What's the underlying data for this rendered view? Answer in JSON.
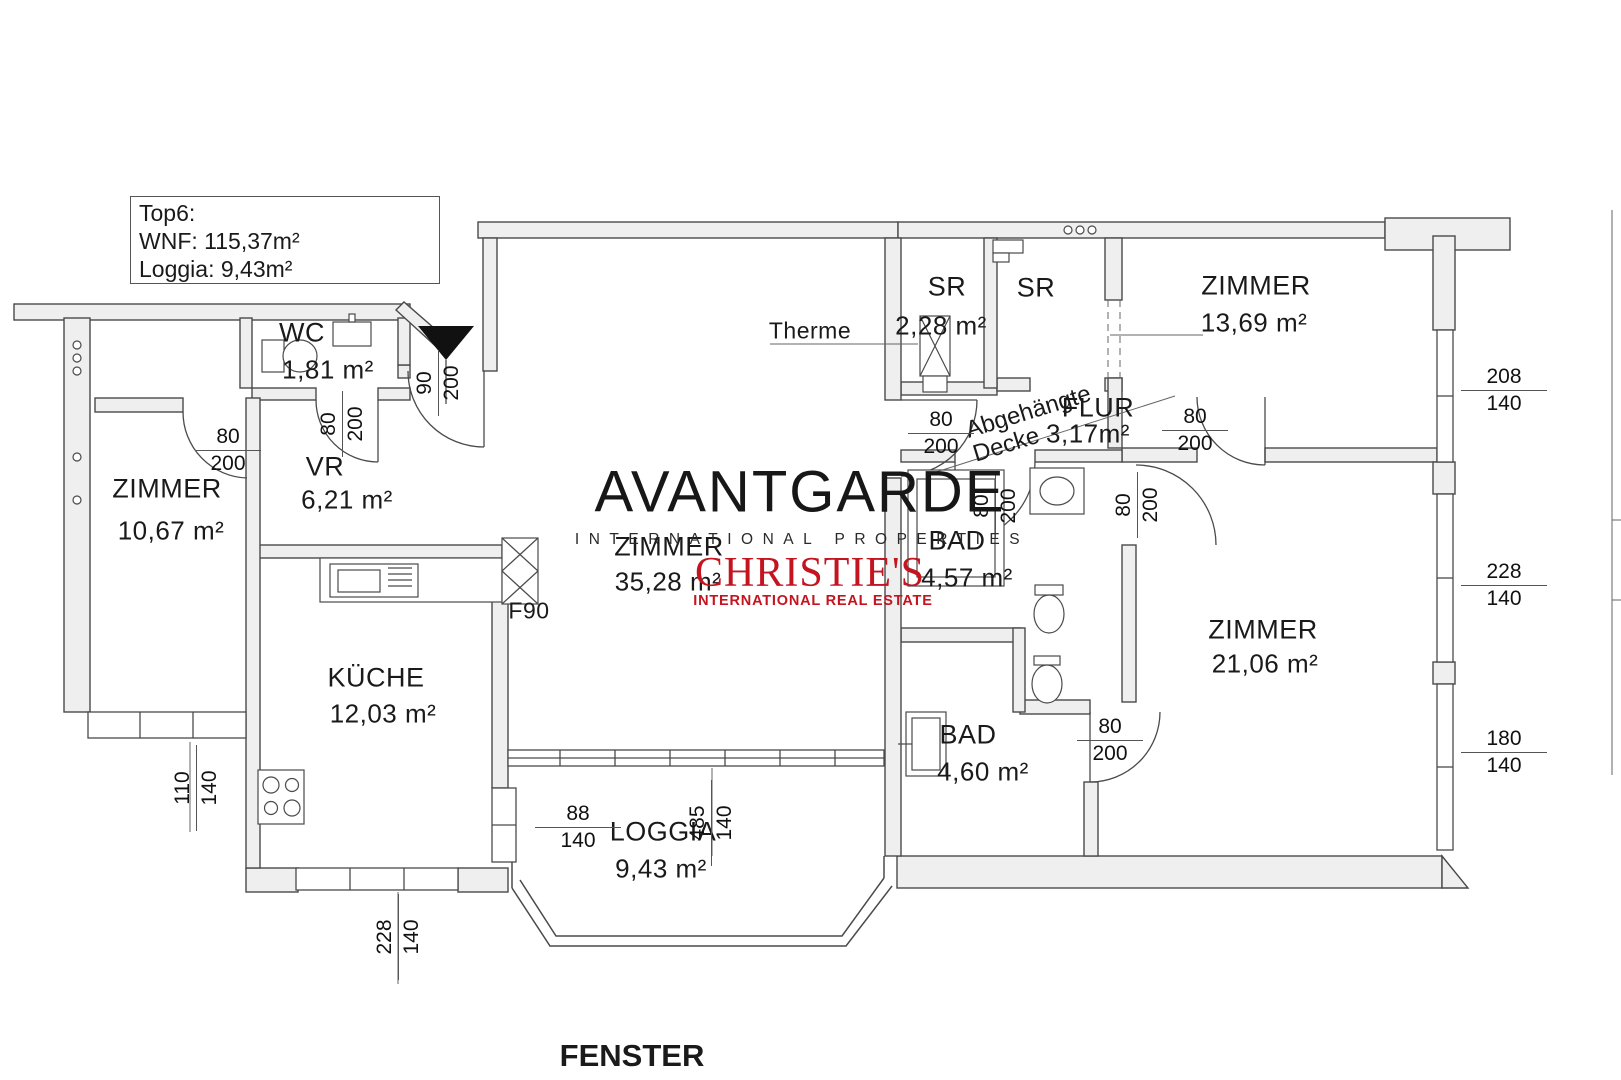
{
  "info_box": {
    "line1": "Top6:",
    "line2": "WNF: 115,37m²",
    "line3": "Loggia: 9,43m²"
  },
  "watermark": {
    "brand": "AVANTGARDE",
    "brand_sub": "INTERNATIONAL PROPERTIES",
    "partner": "CHRISTIE'S",
    "partner_sub": "INTERNATIONAL REAL ESTATE",
    "brand_color": "#171717",
    "partner_color": "#c3141f"
  },
  "rooms": {
    "wc": {
      "name": "WC",
      "area": "1,81 m²"
    },
    "zimmer_left": {
      "name": "ZIMMER",
      "area": "10,67 m²"
    },
    "vr": {
      "name": "VR",
      "area": "6,21 m²"
    },
    "kueche": {
      "name": "KÜCHE",
      "area": "12,03 m²"
    },
    "zimmer_main": {
      "name": "ZIMMER",
      "area": "35,28 m²"
    },
    "loggia": {
      "name": "LOGGIA",
      "area": "9,43 m²"
    },
    "sr_small": {
      "name": "SR",
      "area": "2,28 m²"
    },
    "sr_large": {
      "name": "SR"
    },
    "zimmer_top_right": {
      "name": "ZIMMER",
      "area": "13,69 m²"
    },
    "flur": {
      "name": "FLUR",
      "area": "3,17m²"
    },
    "bad_upper": {
      "name": "BAD",
      "area": "4,57 m²"
    },
    "zimmer_right": {
      "name": "ZIMMER",
      "area": "21,06 m²"
    },
    "bad_lower": {
      "name": "BAD",
      "area": "4,60 m²"
    }
  },
  "annotations": {
    "therme": "Therme",
    "ceiling_line1": "Abgehängte",
    "ceiling_line2": "Decke",
    "fire_rating": "F90",
    "fenster": "FENSTER"
  },
  "dimensions": {
    "door_zimmer_left": {
      "w": "80",
      "h": "200"
    },
    "door_wc": {
      "w": "80",
      "h": "200"
    },
    "door_entrance": {
      "w": "90",
      "h": "200"
    },
    "door_hall": {
      "w": "80",
      "h": "200"
    },
    "door_flur_right": {
      "w": "80",
      "h": "200"
    },
    "door_bad_upper": {
      "w": "80",
      "h": "200"
    },
    "door_zimmer_right": {
      "w": "80",
      "h": "200"
    },
    "door_bad_lower": {
      "w": "80",
      "h": "200"
    },
    "window_right_top": {
      "w": "208",
      "h": "140"
    },
    "window_right_mid": {
      "w": "228",
      "h": "140"
    },
    "window_right_bottom": {
      "w": "180",
      "h": "140"
    },
    "window_left": {
      "w": "110",
      "h": "140"
    },
    "window_kitchen": {
      "w": "228",
      "h": "140"
    },
    "window_loggia_side": {
      "w": "88",
      "h": "140"
    },
    "window_loggia_front": {
      "w": "485",
      "h": "140"
    }
  }
}
